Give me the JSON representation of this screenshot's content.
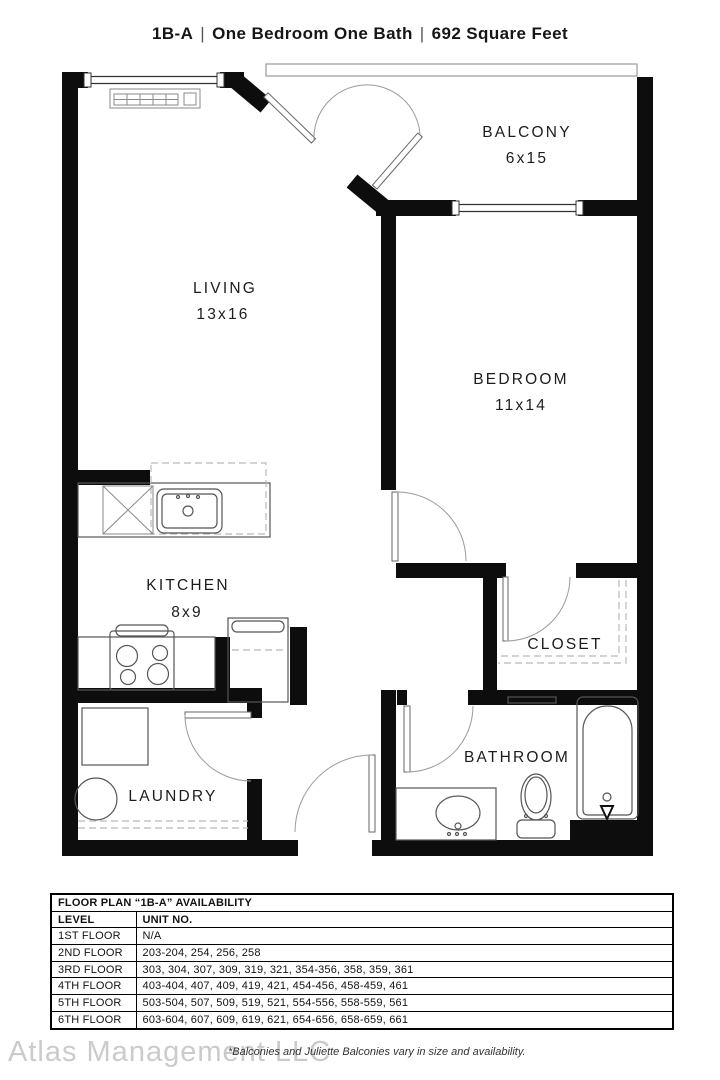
{
  "title": {
    "code": "1B-A",
    "separator": "|",
    "type": "One Bedroom One Bath",
    "area": "692 Square Feet"
  },
  "rooms": {
    "living": {
      "name": "LIVING",
      "dims": "13x16"
    },
    "balcony": {
      "name": "BALCONY",
      "dims": "6x15"
    },
    "bedroom": {
      "name": "BEDROOM",
      "dims": "11x14"
    },
    "kitchen": {
      "name": "KITCHEN",
      "dims": "8x9"
    },
    "closet": {
      "name": "CLOSET"
    },
    "laundry": {
      "name": "LAUNDRY"
    },
    "bathroom": {
      "name": "BATHROOM"
    }
  },
  "availability": {
    "title": "FLOOR PLAN “1B-A” AVAILABILITY",
    "columns": {
      "level": "LEVEL",
      "unit": "UNIT NO."
    },
    "rows": [
      {
        "level": "1ST FLOOR",
        "units": "N/A"
      },
      {
        "level": "2ND FLOOR",
        "units": "203-204, 254, 256, 258"
      },
      {
        "level": "3RD FLOOR",
        "units": "303, 304, 307, 309, 319, 321, 354-356, 358, 359, 361"
      },
      {
        "level": "4TH FLOOR",
        "units": "403-404, 407, 409, 419, 421, 454-456, 458-459, 461"
      },
      {
        "level": "5TH FLOOR",
        "units": "503-504, 507, 509, 519, 521, 554-556, 558-559, 561"
      },
      {
        "level": "6TH FLOOR",
        "units": "603-604, 607, 609, 619, 621, 654-656, 658-659, 661"
      }
    ]
  },
  "footer": {
    "watermark": "Atlas Management LLC",
    "note": "*Balconies and Juliette Balconies vary in size and availability."
  },
  "colors": {
    "wall": "#0d0d0d",
    "background": "#ffffff"
  }
}
